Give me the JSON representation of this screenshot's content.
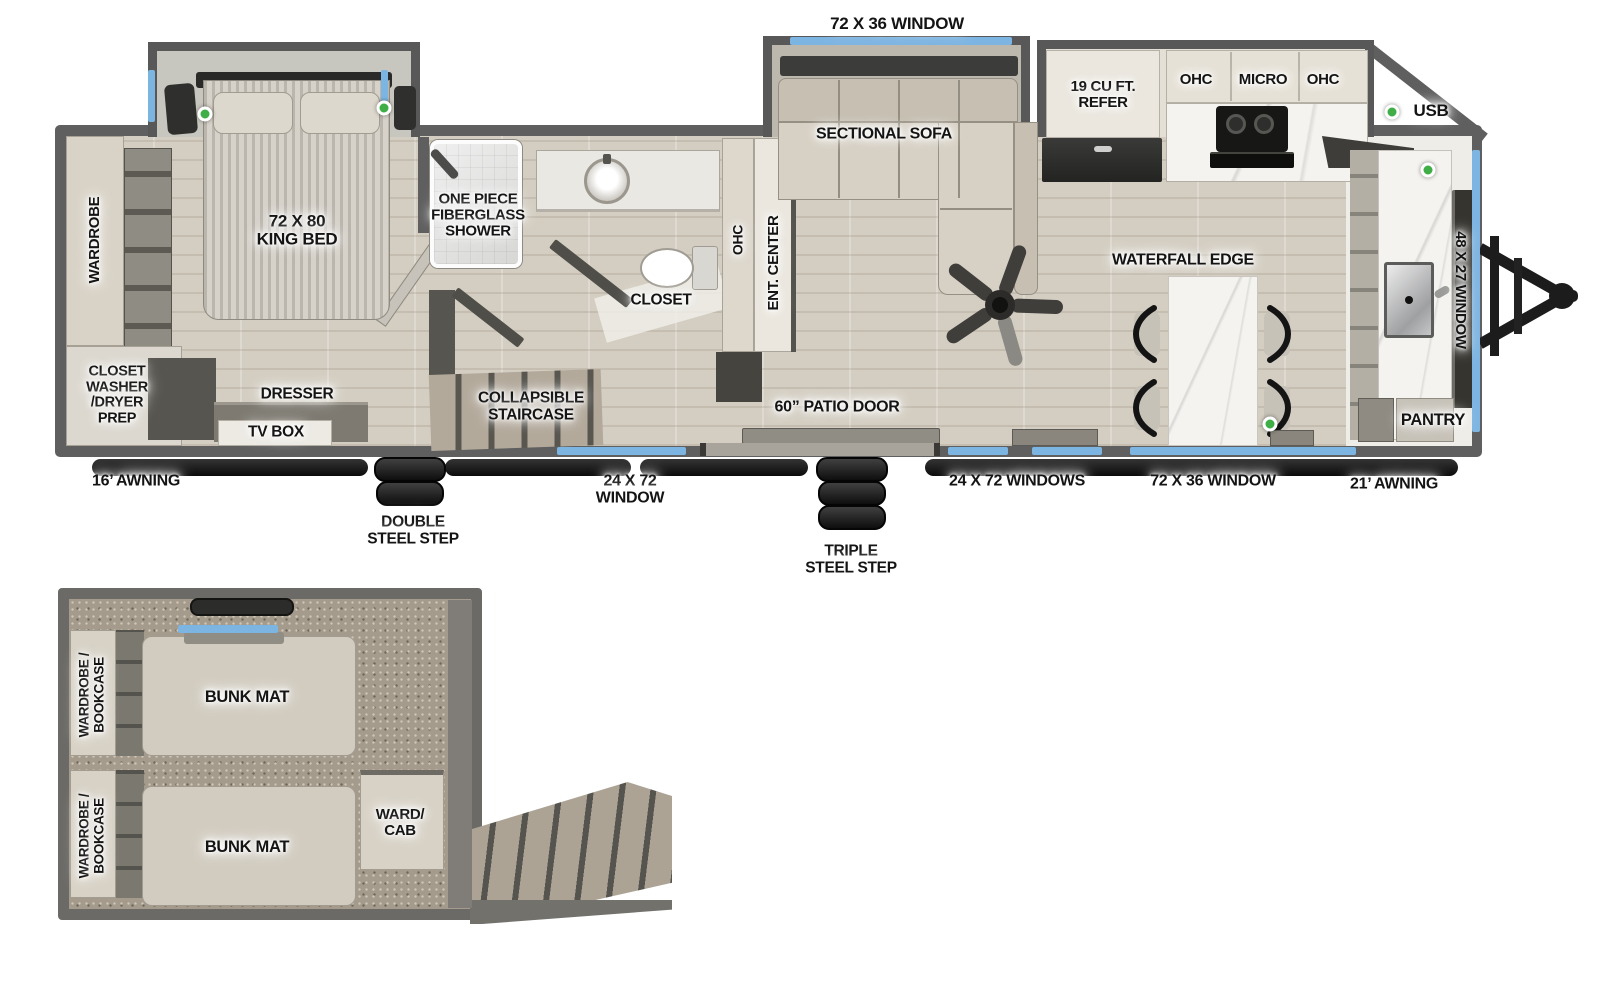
{
  "legend": {
    "usb": "USB"
  },
  "exterior": {
    "window_72x36_top": "72 X 36 WINDOW",
    "window_48x27": "48 X 27 WINDOW",
    "window_24x72": "24 X 72\nWINDOW",
    "windows_24x72": "24 X 72 WINDOWS",
    "window_72x36_bottom": "72 X 36 WINDOW",
    "patio_door": "60” PATIO DOOR",
    "awning_16": "16’ AWNING",
    "awning_21": "21’ AWNING",
    "double_step": "DOUBLE\nSTEEL STEP",
    "triple_step": "TRIPLE\nSTEEL STEP"
  },
  "bedroom": {
    "wardrobe": "WARDROBE",
    "king_bed": "72 X 80\nKING BED",
    "closet_washer": "CLOSET\nWASHER\n/DRYER\nPREP",
    "dresser": "DRESSER",
    "tv_box": "TV BOX"
  },
  "bath": {
    "shower": "ONE PIECE\nFIBERGLASS\nSHOWER",
    "closet": "CLOSET",
    "ohc": "OHC"
  },
  "living": {
    "ent_center": "ENT. CENTER",
    "sectional_sofa": "SECTIONAL SOFA",
    "collapsible_staircase": "COLLAPSIBLE\nSTAIRCASE"
  },
  "kitchen": {
    "refer": "19 CU FT.\nREFER",
    "ohc_left": "OHC",
    "micro": "MICRO",
    "ohc_right": "OHC",
    "waterfall_edge": "WATERFALL EDGE",
    "pantry": "PANTRY"
  },
  "bunk_room": {
    "wardrobe_bookcase_top": "WARDROBE /\nBOOKCASE",
    "wardrobe_bookcase_bottom": "WARDROBE /\nBOOKCASE",
    "bunk_mat_top": "BUNK MAT",
    "bunk_mat_bottom": "BUNK MAT",
    "ward_cab": "WARD/\nCAB"
  },
  "colors": {
    "window_blue": "#7db5e2",
    "usb_green": "#3fae47",
    "wall_gray": "#5f5f5f"
  }
}
